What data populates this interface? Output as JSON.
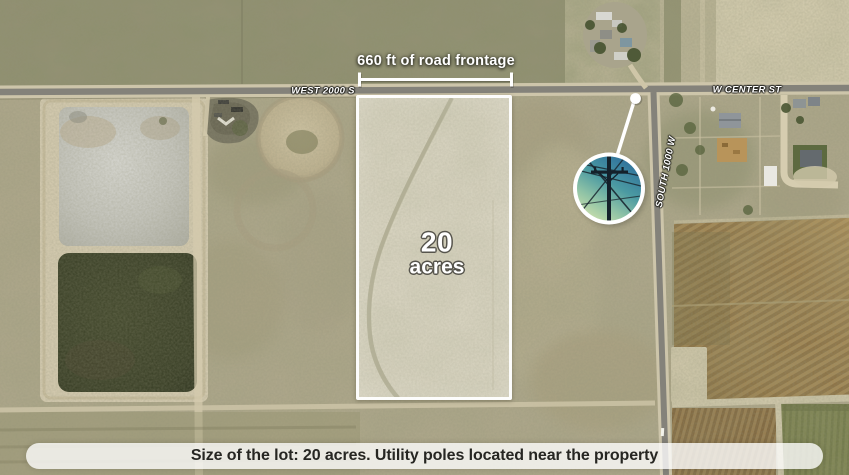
{
  "annotations": {
    "frontage_label": "660 ft of road frontage",
    "lot_size_number": "20",
    "lot_size_unit": "acres"
  },
  "road_labels": {
    "west_2000_s": "WEST 2000 S",
    "w_center_st": "W CENTER ST",
    "south_1000_w": "SOUTH 1000 W"
  },
  "caption": "Size of the lot: 20 acres. Utility poles located near the property",
  "inset": {
    "photo_icon": "utility-pole-photo",
    "marker_icon": "location-dot"
  },
  "colors": {
    "annotation": "#ffffff",
    "parcel_outline": "#ffffff",
    "caption_background": "rgba(255,255,255,0.78)",
    "caption_text": "#262622"
  }
}
